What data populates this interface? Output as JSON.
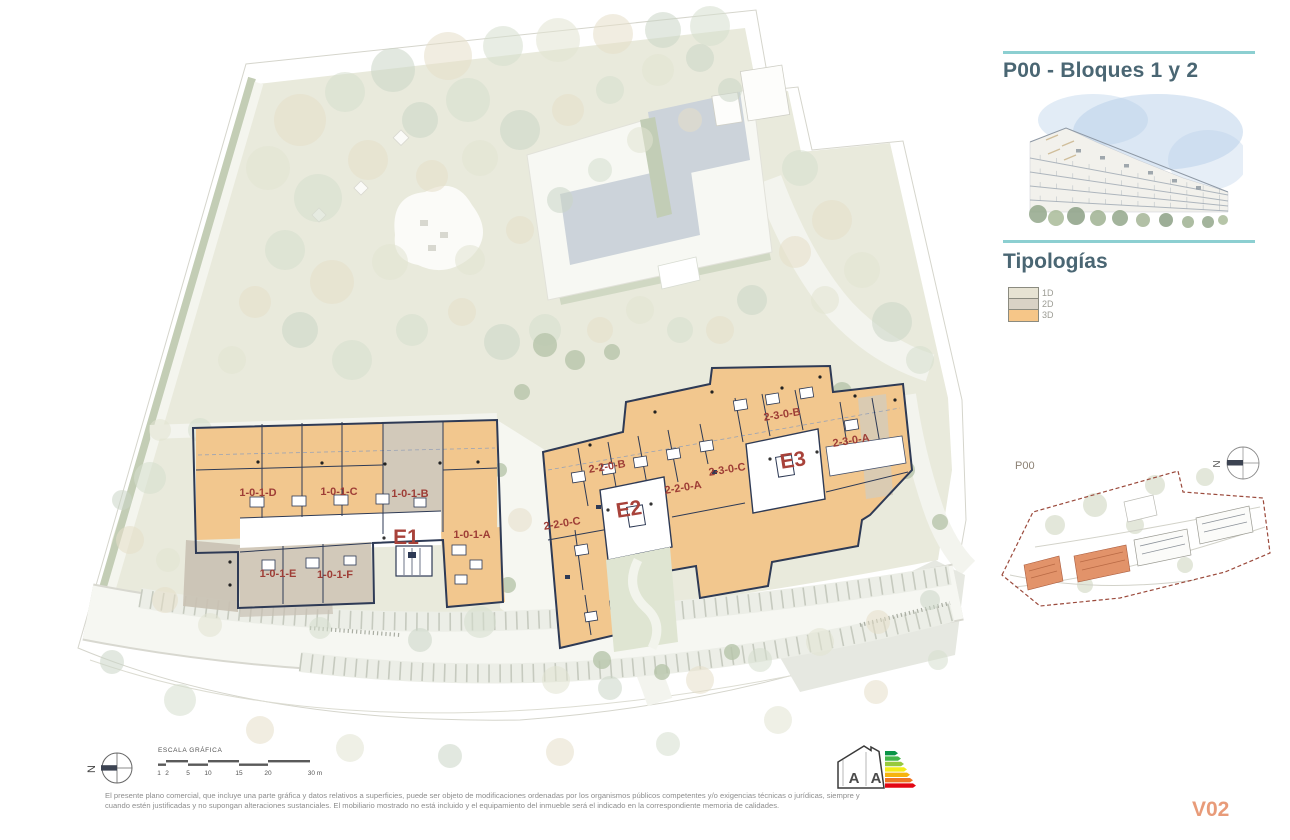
{
  "panel": {
    "title": "P00 - Bloques 1 y 2",
    "typologies": {
      "heading": "Tipologías",
      "items": [
        {
          "label": "1D",
          "color": "#e7e3d3"
        },
        {
          "label": "2D",
          "color": "#d9d2c5"
        },
        {
          "label": "3D",
          "color": "#f6c688"
        }
      ]
    },
    "minimap": {
      "label": "P00",
      "north": "N"
    }
  },
  "plan": {
    "north": "N",
    "block1": {
      "name": "E1",
      "units": [
        "1-0-1-D",
        "1-0-1-C",
        "1-0-1-B",
        "1-0-1-A",
        "1-0-1-E",
        "1-0-1-F"
      ]
    },
    "block2": {
      "name_e2": "E2",
      "name_e3": "E3",
      "units": [
        "2-2-0-C",
        "2-2-0-B",
        "2-2-0-A",
        "2-3-0-C",
        "2-3-0-B",
        "2-3-0-A"
      ]
    }
  },
  "scalebar": {
    "title": "ESCALA GRÁFICA",
    "ticks": [
      "1",
      "2",
      "5",
      "10",
      "15",
      "20",
      "30 m"
    ]
  },
  "energy_logo": {
    "letters": [
      "A",
      "A"
    ]
  },
  "footer": {
    "disclaimer_line1": "El presente plano comercial, que incluye una parte gráfica y datos relativos a superficies, puede ser objeto de modificaciones ordenadas por los organismos públicos competentes y/o exigencias técnicas o jurídicas, siempre y",
    "disclaimer_line2": "cuando estén justificadas y no supongan alteraciones sustanciales. El mobiliario mostrado no está incluido y el equipamiento del inmueble será el indicado en la correspondiente memoria de calidades.",
    "version": "V02"
  },
  "colors": {
    "teal_rule": "#8ccfd1",
    "heading": "#4a6673",
    "unit_label_red": "#9e3d36",
    "block_label_red": "#a8423a",
    "building_orange": "#f2c78e",
    "building_tan": "#d2c9ba",
    "wall_navy": "#2e3a55",
    "version_orange": "#e89b79",
    "minimap_building_orange": "#e2936a",
    "minimap_boundary_red": "#9b4a3c"
  }
}
